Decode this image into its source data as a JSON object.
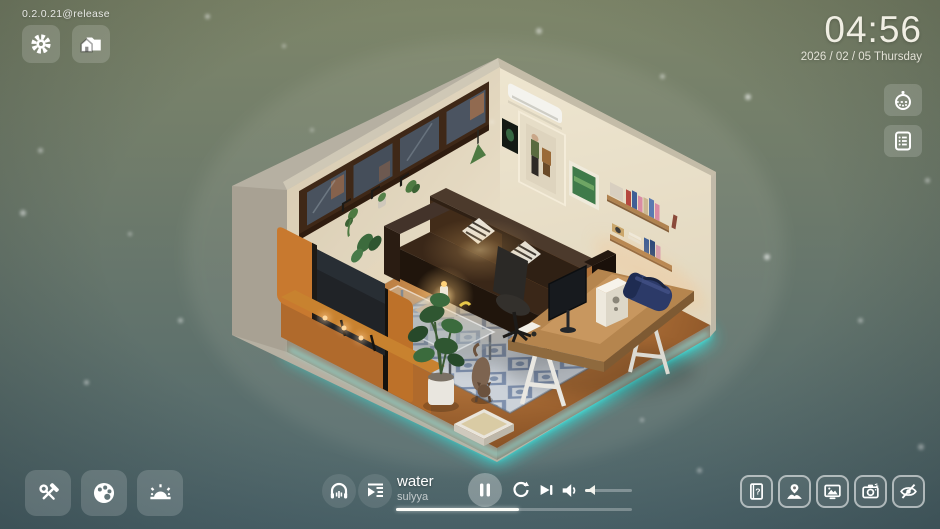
{
  "version_label": "0.2.0.21@release",
  "clock": {
    "time": "04:56",
    "date": "2026 / 02 / 05 Thursday"
  },
  "top_left": {
    "buttons": [
      {
        "icon": "gear-icon"
      },
      {
        "icon": "home-folder-icon"
      }
    ]
  },
  "right_panel": {
    "buttons": [
      {
        "icon": "gacha-ball-icon"
      },
      {
        "icon": "checklist-icon"
      }
    ]
  },
  "bottom_left": {
    "buttons": [
      {
        "icon": "tools-icon"
      },
      {
        "icon": "palette-icon"
      },
      {
        "icon": "weather-sun-icon"
      }
    ]
  },
  "player": {
    "track_title": "water",
    "artist": "sulyya",
    "progress_percent": 52,
    "volume_percent": 15,
    "icons": {
      "ambience": "headphones-icon",
      "queue": "playlist-icon",
      "pause": "pause-icon",
      "repeat": "repeat-icon",
      "next": "skip-next-icon",
      "volume": "speaker-icon"
    }
  },
  "bottom_right": {
    "buttons": [
      {
        "icon": "help-book-icon"
      },
      {
        "icon": "person-pin-icon"
      },
      {
        "icon": "gallery-icon"
      },
      {
        "icon": "camera-icon"
      },
      {
        "icon": "hide-ui-icon"
      }
    ]
  },
  "scene": {
    "glow_color": "#35e3df",
    "background_top": "#7e8669",
    "background_mid": "#6d7a6b",
    "background_bottom": "#4e676e",
    "colors": {
      "exterior": "#b6b0a2",
      "wall_left": "#e3d8c0",
      "wall_right": "#ece2cb",
      "floor_center": "#c88a4a",
      "sofa": "#2f2014",
      "tv_cabinet": "#c8792f",
      "rug": "#ccd2d9",
      "rug_pattern": "#4a648e",
      "desk": "#b5854e",
      "window_frame": "#3f2817"
    }
  }
}
